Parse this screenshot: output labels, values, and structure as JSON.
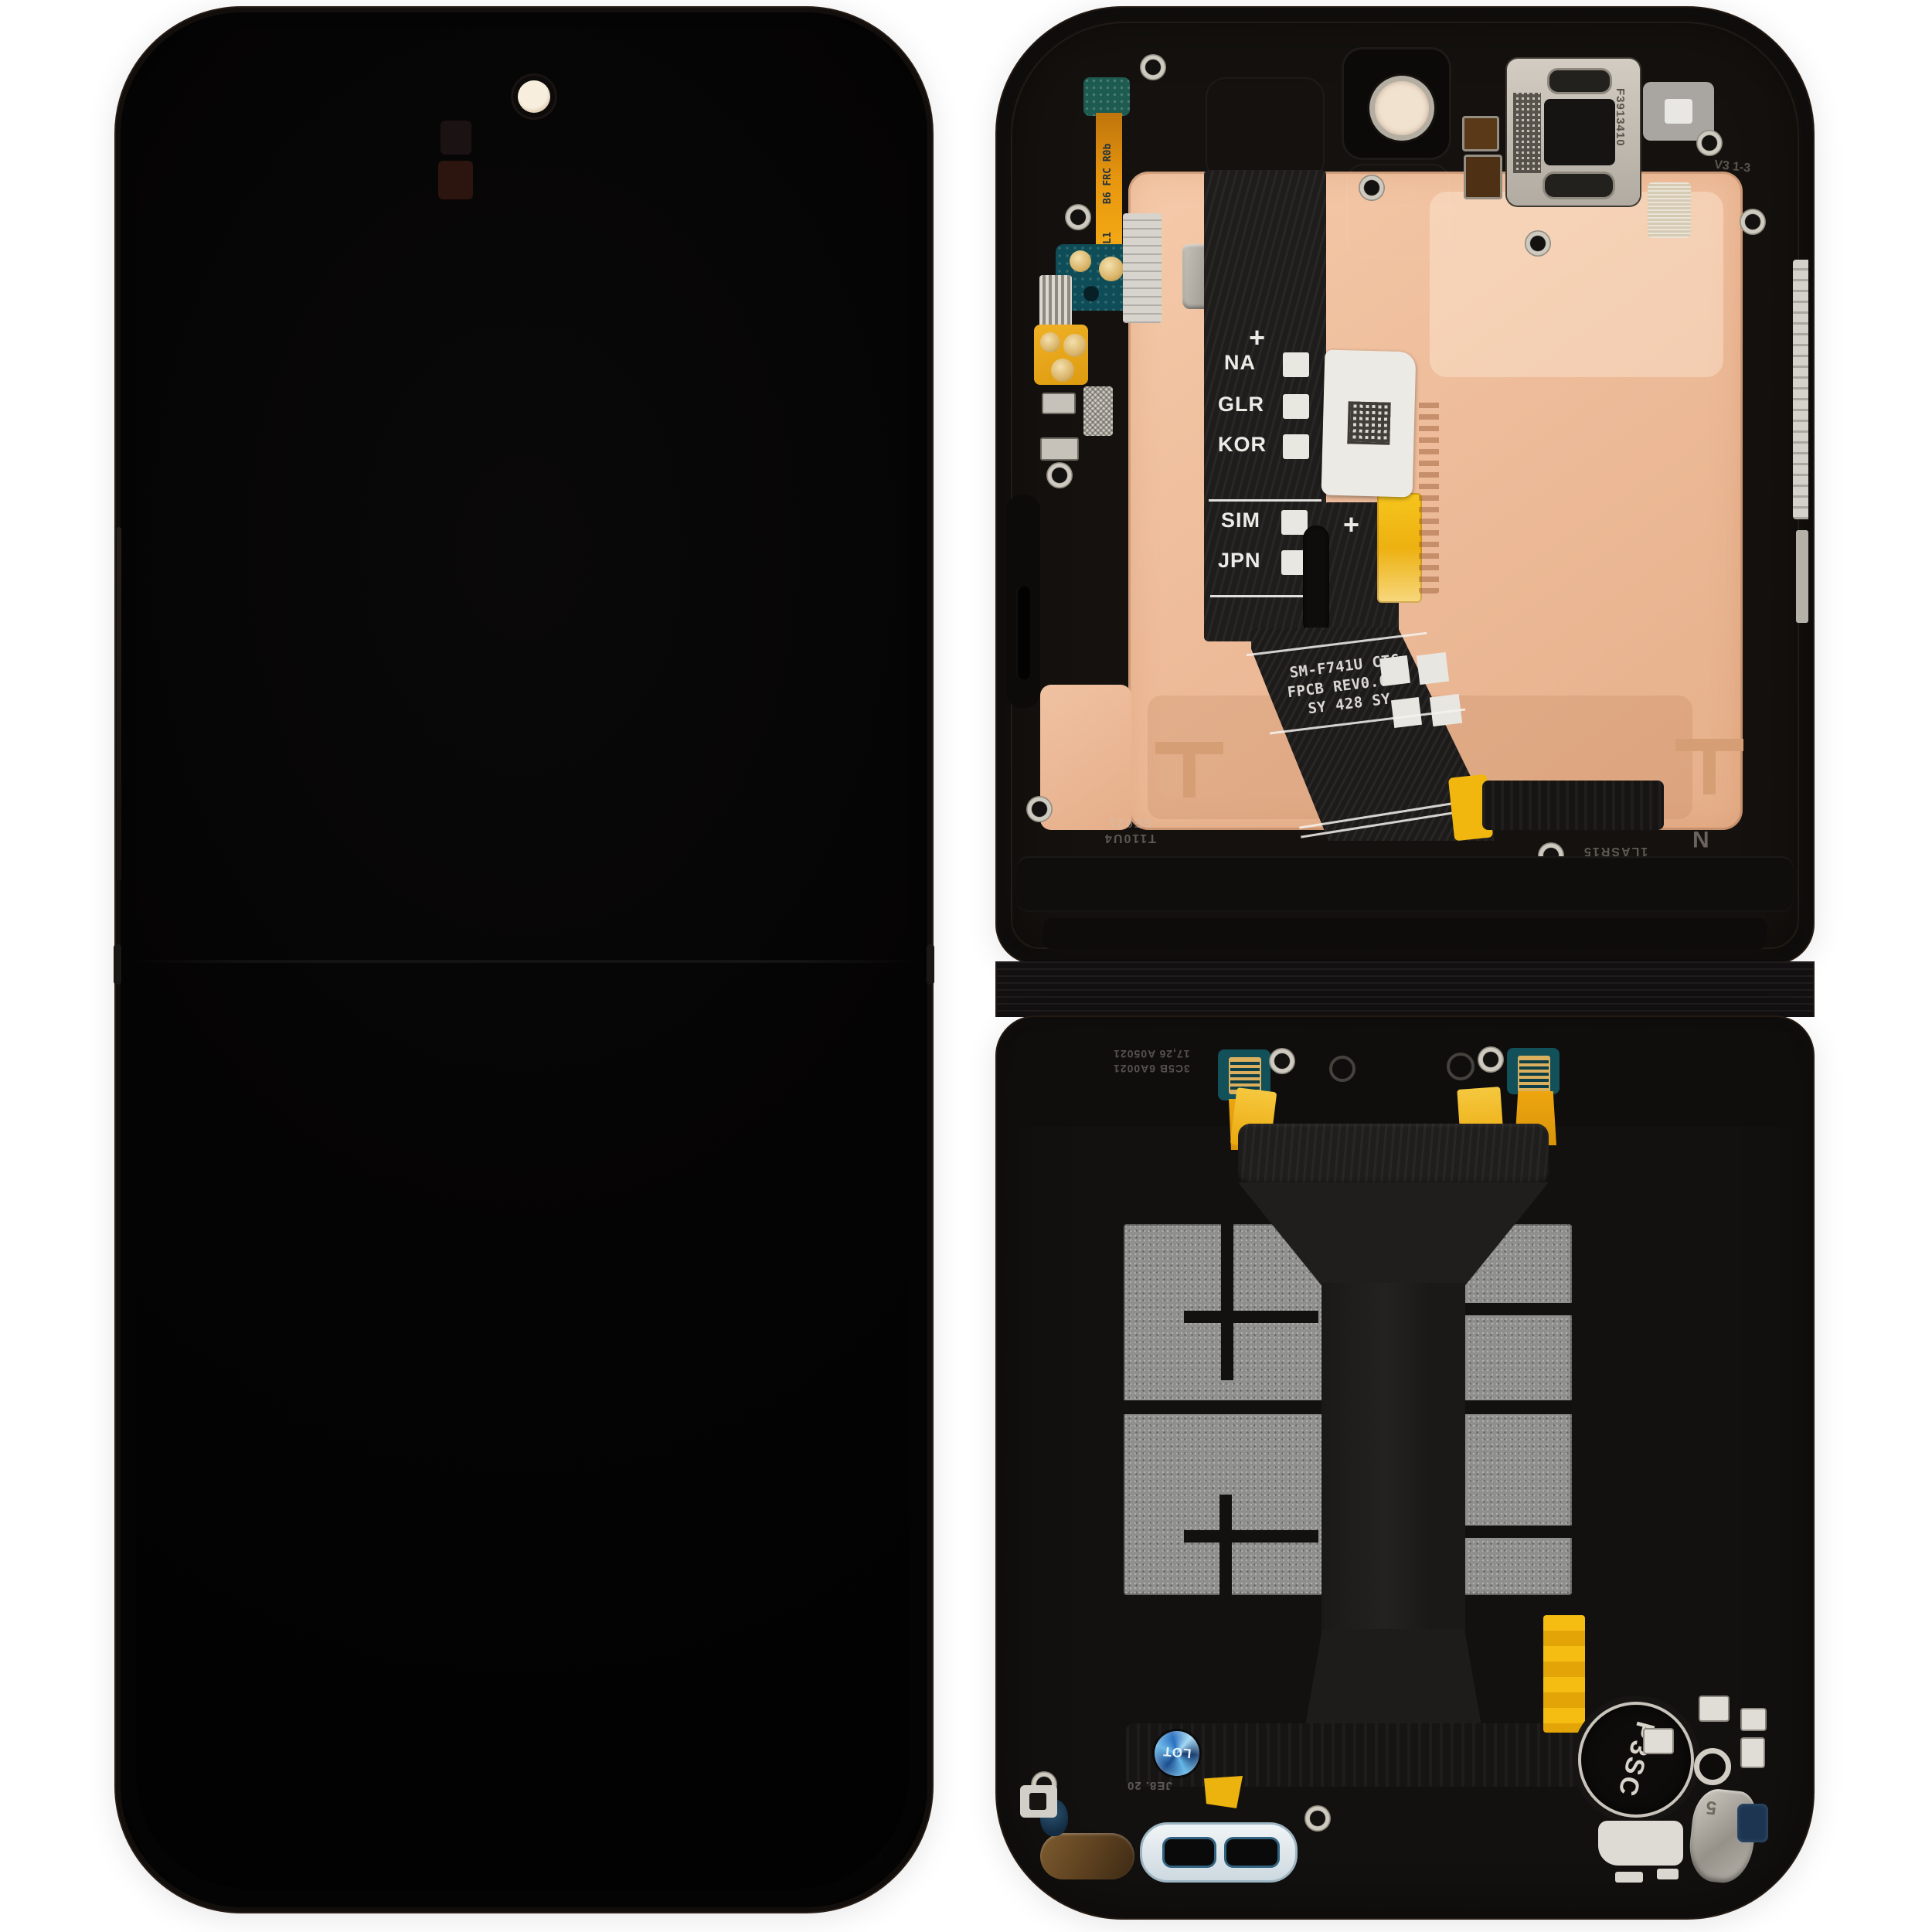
{
  "colors": {
    "background": "#ffffff",
    "phone_black": "#0b0909",
    "frame_black": "#15120f",
    "copper_shield": "#f0c2a2",
    "graphite_pad": "#8f8f8d",
    "kapton_gold": "#f0b40e",
    "flex_black": "#1d1c1b",
    "pcb_teal": "#12505a",
    "sticker_white": "#ece9e4"
  },
  "flex_label_panel": {
    "plus_top": "+",
    "rows_top": [
      {
        "label": "NA"
      },
      {
        "label": "GLR"
      },
      {
        "label": "KOR"
      }
    ],
    "rows_bottom": [
      {
        "label": "SIM"
      },
      {
        "label": "JPN"
      }
    ],
    "plus_bottom": "+"
  },
  "flex_print": {
    "line1": "SM-F741U CTC",
    "line2": "FPCB REV0.6L2",
    "line3": "SY 428 SY"
  },
  "front_cam_flex": {
    "code_top": "B6 FRC R0b",
    "code_bottom": "HF DS 4 7SL1"
  },
  "earpiece": {
    "code": "F3913410"
  },
  "top_frame_marks": {
    "code_a": "T110U4",
    "code_b": "SE021",
    "code_c": "1LASR15",
    "letter_n": "N",
    "vcode": "V3 1-3"
  },
  "bottom_frame_marks": {
    "code_line1": "3C5B 6A0021",
    "code_line2": "17,26 A05021",
    "date_code": "JE8. 20"
  },
  "bottom_parts": {
    "p3sc_stamp": "P3SC",
    "lot_sticker": "LOT",
    "bracket_digit": "5"
  }
}
